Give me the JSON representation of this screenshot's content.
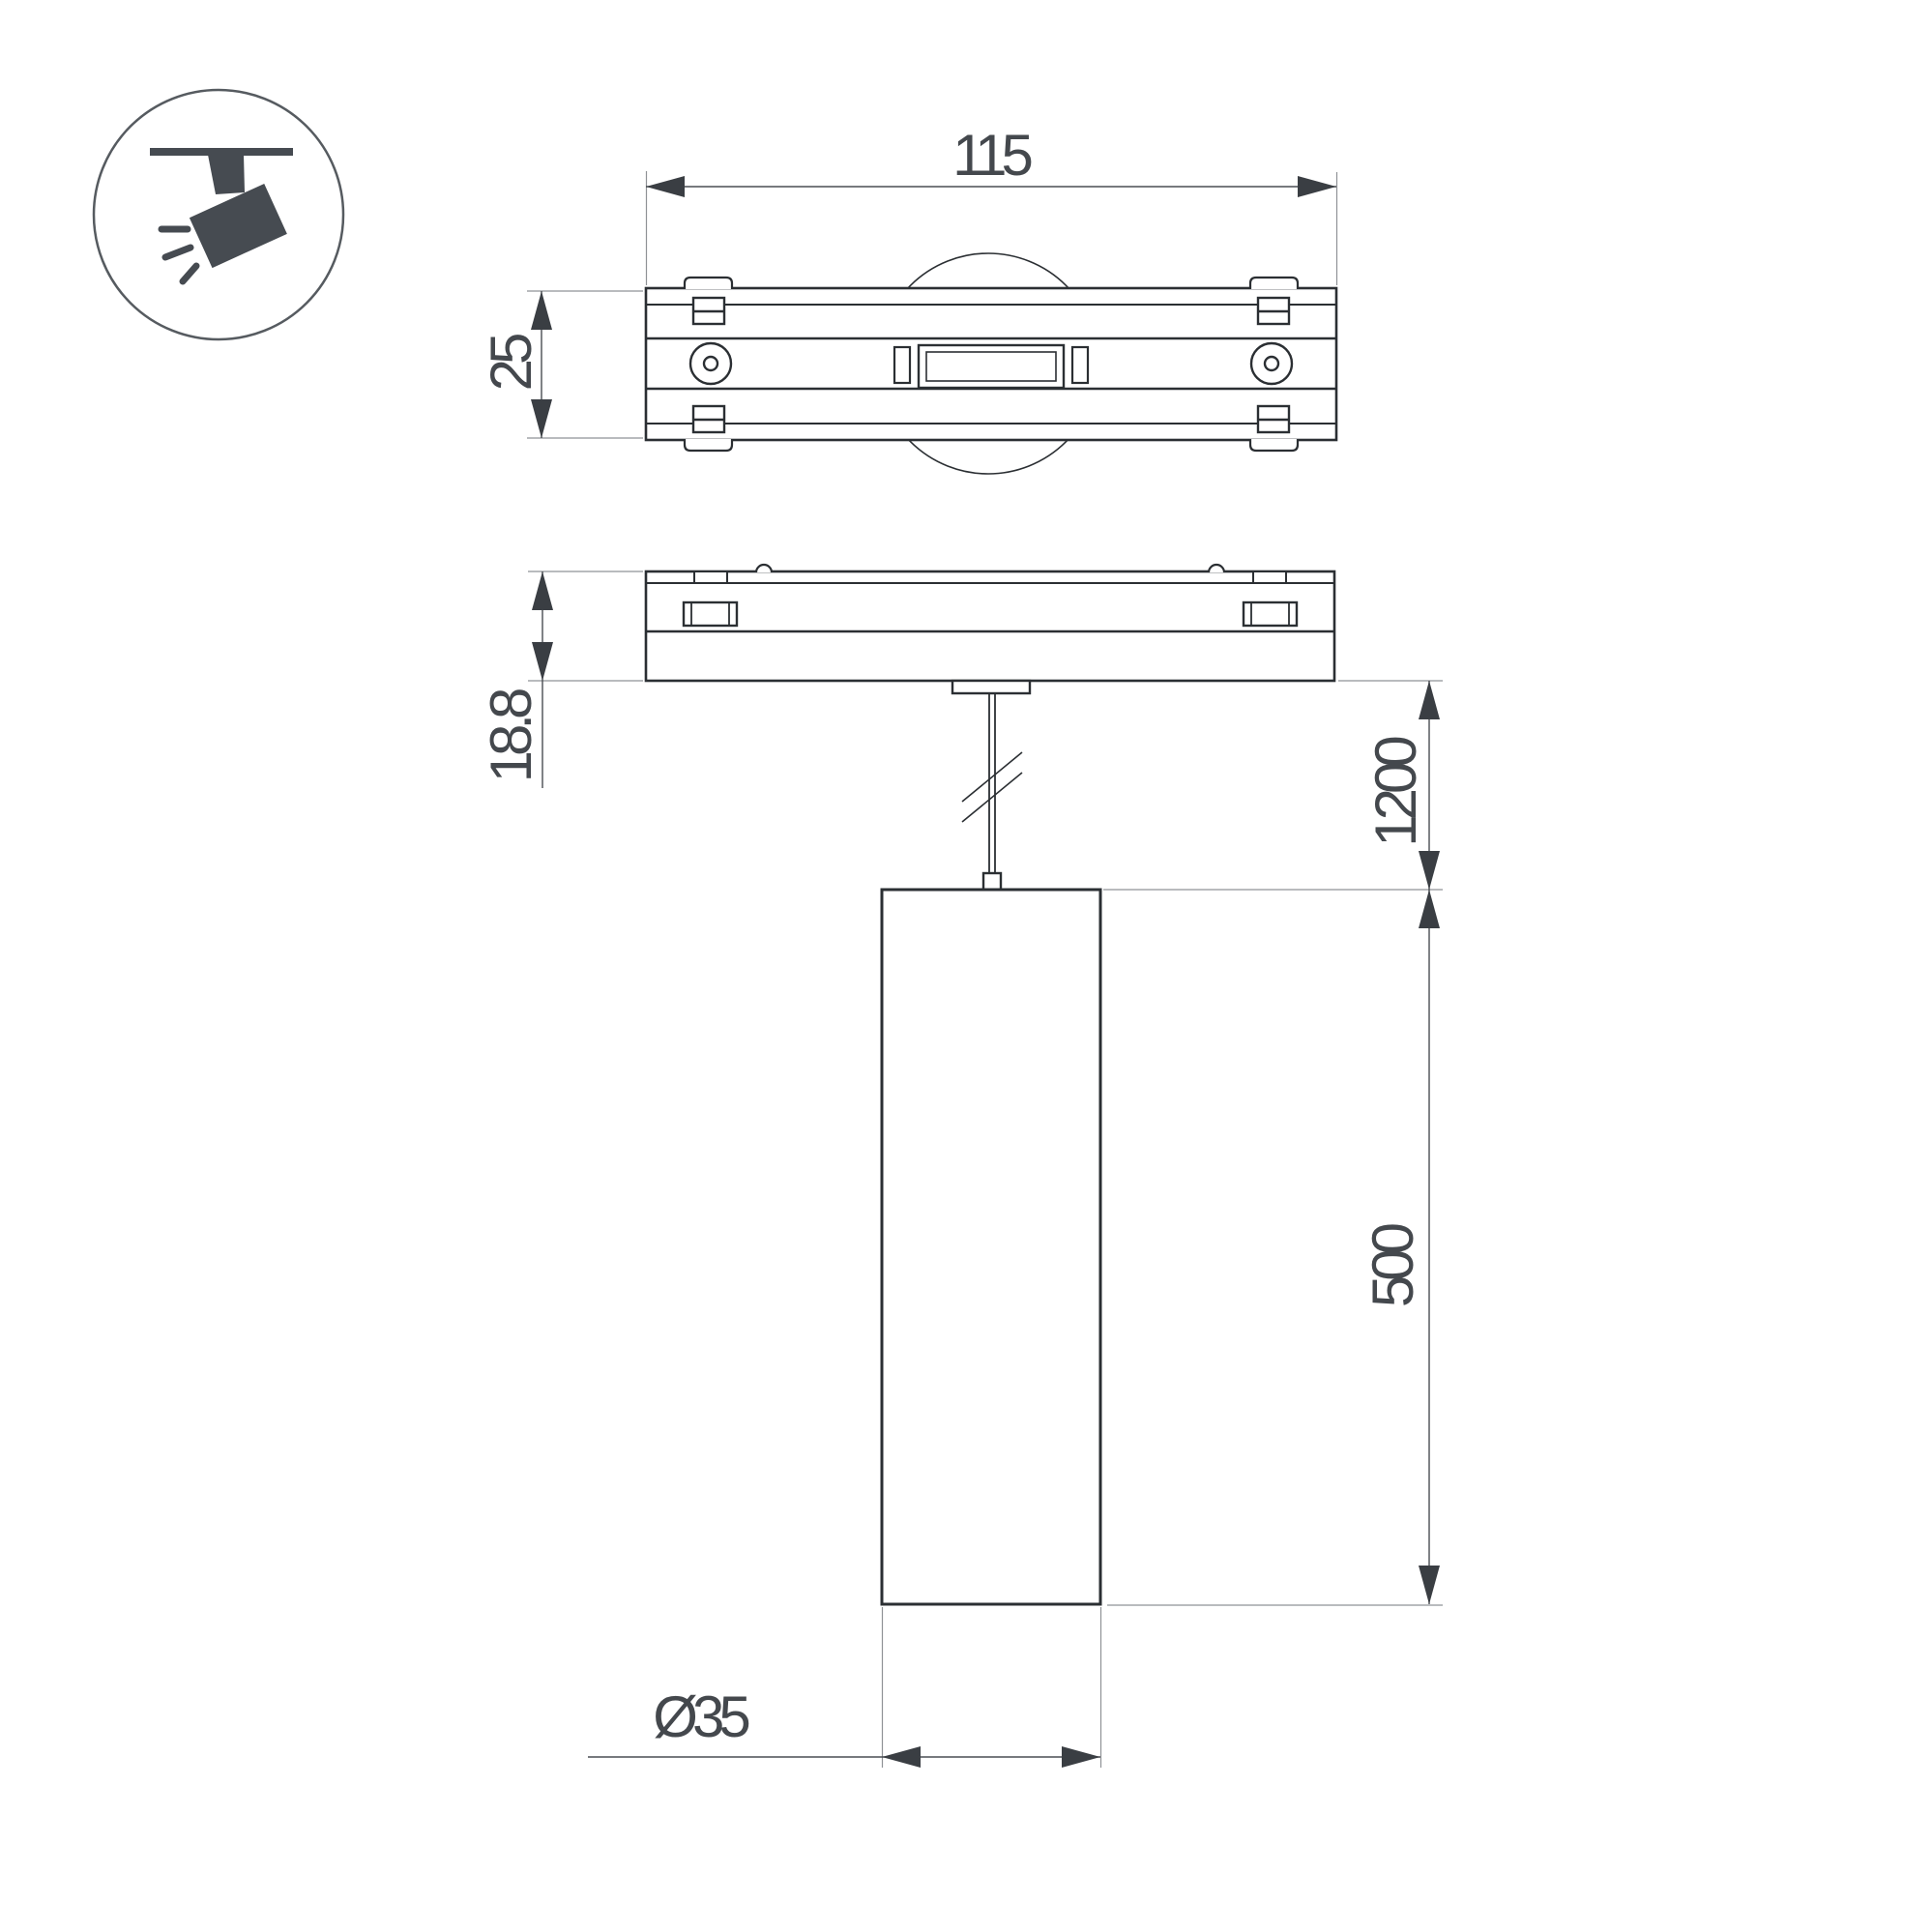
{
  "page": {
    "background": "#ffffff",
    "type": "technical-dimension-drawing",
    "subject": "magnet-track pendant spot luminaire"
  },
  "icon": {
    "name": "track-spotlight-icon",
    "meaning": "ceiling track mounted spot light pictogram"
  },
  "dimensions": {
    "track_width": "115",
    "track_depth": "25",
    "adapter_height": "18.8",
    "suspension_length": "1200",
    "body_height": "500",
    "body_diameter": "Ø35"
  },
  "colors": {
    "outline": "#2b2f33",
    "dimension_line": "#4a4e53",
    "extension_line": "#8f9296",
    "arrow": "#3a3e43",
    "text": "#44484d",
    "icon_glyph": "#464b51",
    "background": "#ffffff"
  }
}
